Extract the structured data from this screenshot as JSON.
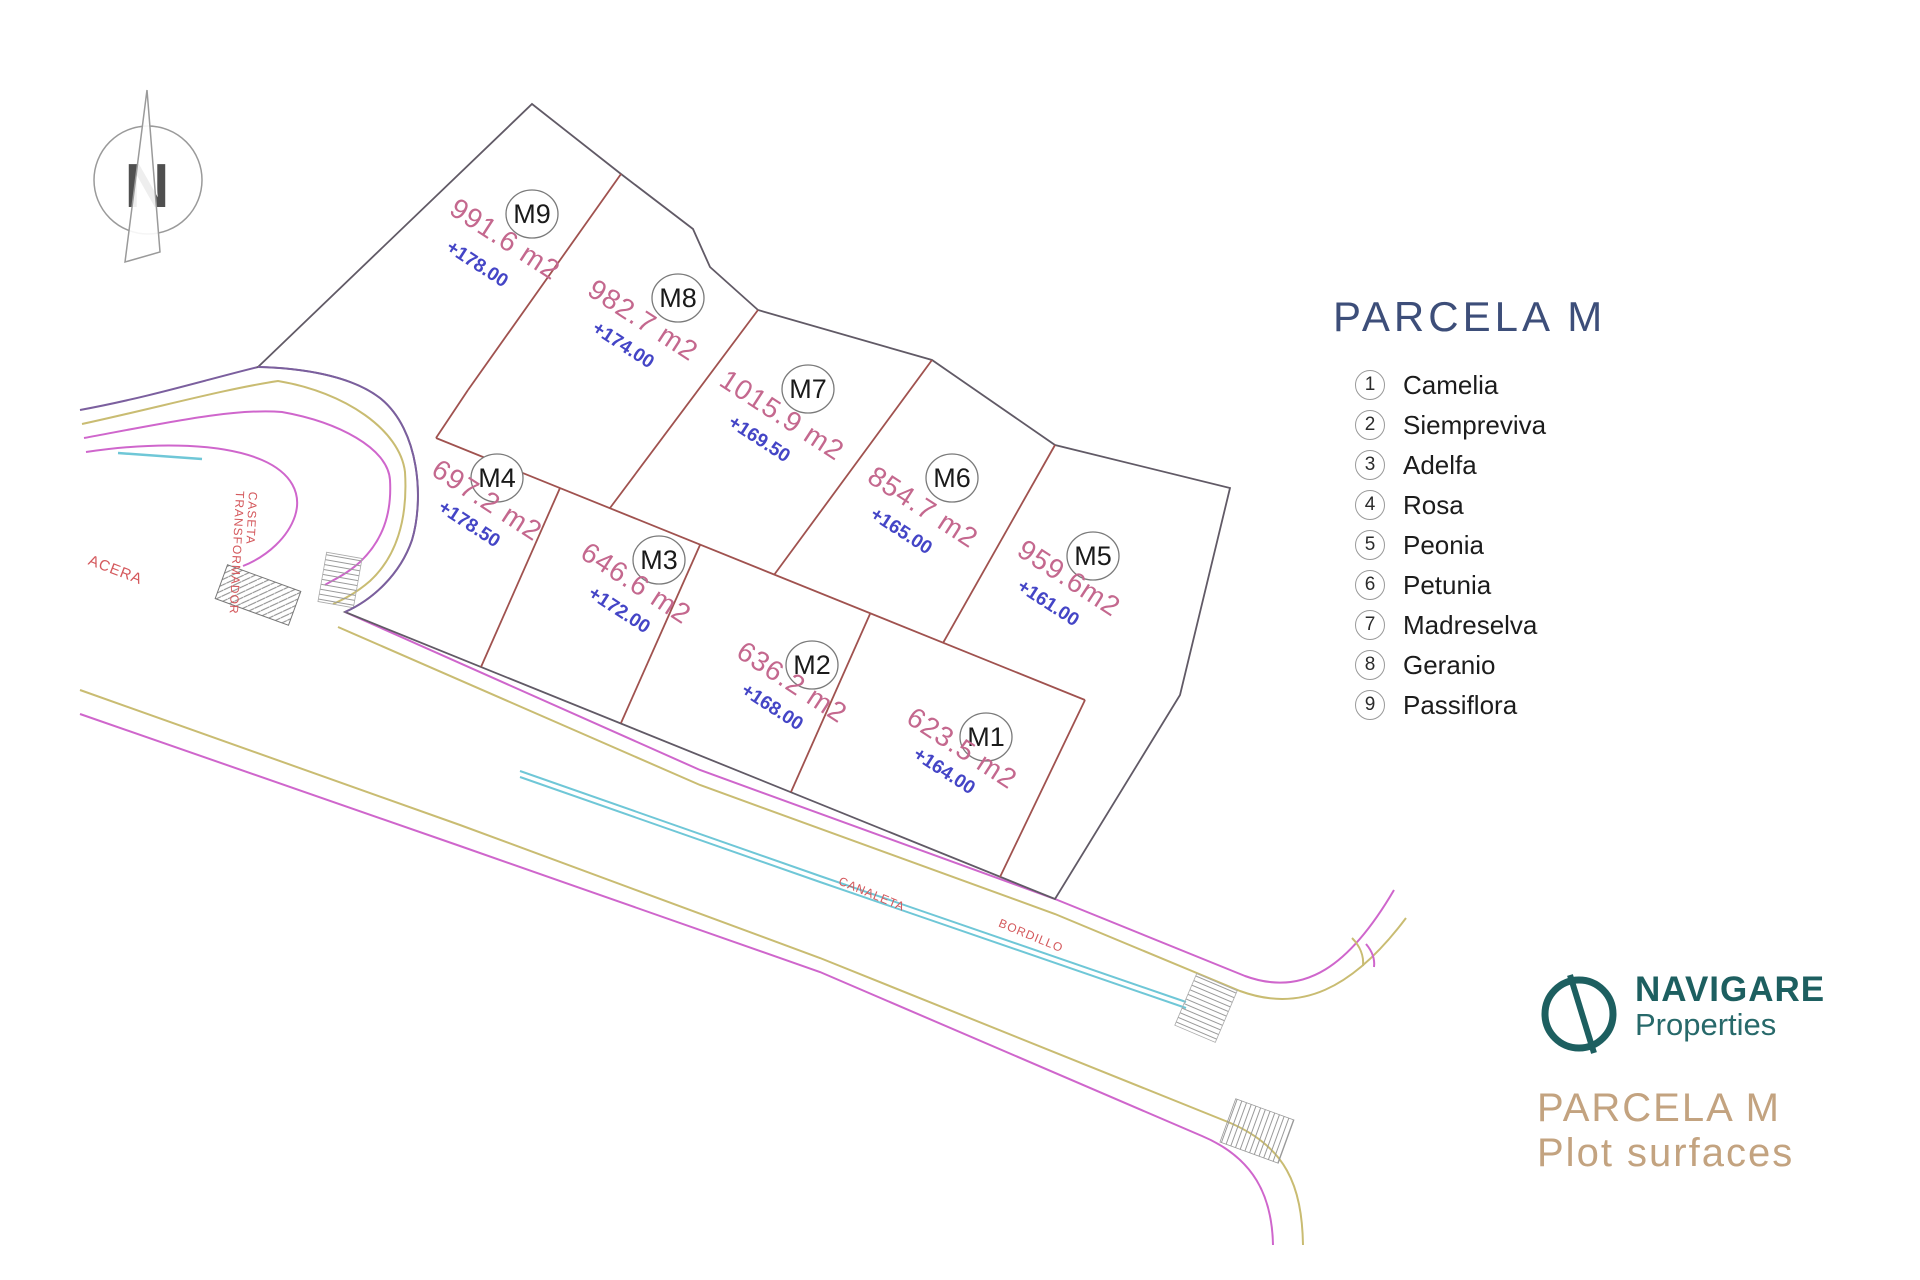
{
  "compass": {
    "letter": "N"
  },
  "map_labels": {
    "acera": "ACERA",
    "caseta_line1": "CASETA",
    "caseta_line2": "TRANSFORMADOR",
    "canaleta": "CANALETA",
    "bordillo": "BORDILLO"
  },
  "plots": [
    {
      "id": "M1",
      "area": "623.5 m2",
      "elevation": "+164.00"
    },
    {
      "id": "M2",
      "area": "636.2 m2",
      "elevation": "+168.00"
    },
    {
      "id": "M3",
      "area": "646.6 m2",
      "elevation": "+172.00"
    },
    {
      "id": "M4",
      "area": "697.2 m2",
      "elevation": "+178.50"
    },
    {
      "id": "M5",
      "area": "959.6m2",
      "elevation": "+161.00"
    },
    {
      "id": "M6",
      "area": "854.7 m2",
      "elevation": "+165.00"
    },
    {
      "id": "M7",
      "area": "1015.9 m2",
      "elevation": "+169.50"
    },
    {
      "id": "M8",
      "area": "982.7 m2",
      "elevation": "+174.00"
    },
    {
      "id": "M9",
      "area": "991.6 m2",
      "elevation": "+178.00"
    }
  ],
  "legend": {
    "title": "PARCELA M",
    "items": [
      {
        "num": "1",
        "name": "Camelia"
      },
      {
        "num": "2",
        "name": "Siempreviva"
      },
      {
        "num": "3",
        "name": "Adelfa"
      },
      {
        "num": "4",
        "name": "Rosa"
      },
      {
        "num": "5",
        "name": "Peonia"
      },
      {
        "num": "6",
        "name": "Petunia"
      },
      {
        "num": "7",
        "name": "Madreselva"
      },
      {
        "num": "8",
        "name": "Geranio"
      },
      {
        "num": "9",
        "name": "Passiflora"
      }
    ]
  },
  "branding": {
    "name_line1": "NAVIGARE",
    "name_line2": "Properties",
    "subtitle_line1": "PARCELA M",
    "subtitle_line2": "Plot surfaces"
  },
  "colors": {
    "area_text": "#c4688e",
    "elevation_text": "#4445c6",
    "plot_divider": "#a0524f",
    "parcel_boundary": "#615a66",
    "road_magenta": "#cf66cc",
    "road_khaki": "#c9bc72",
    "road_cyan": "#6fc7d7",
    "road_purple": "#7b5f9e",
    "map_label_red": "#d4585c",
    "legend_title_navy": "#3d4e79",
    "brand_teal": "#1d5f60",
    "brand_tan": "#c3a380"
  }
}
